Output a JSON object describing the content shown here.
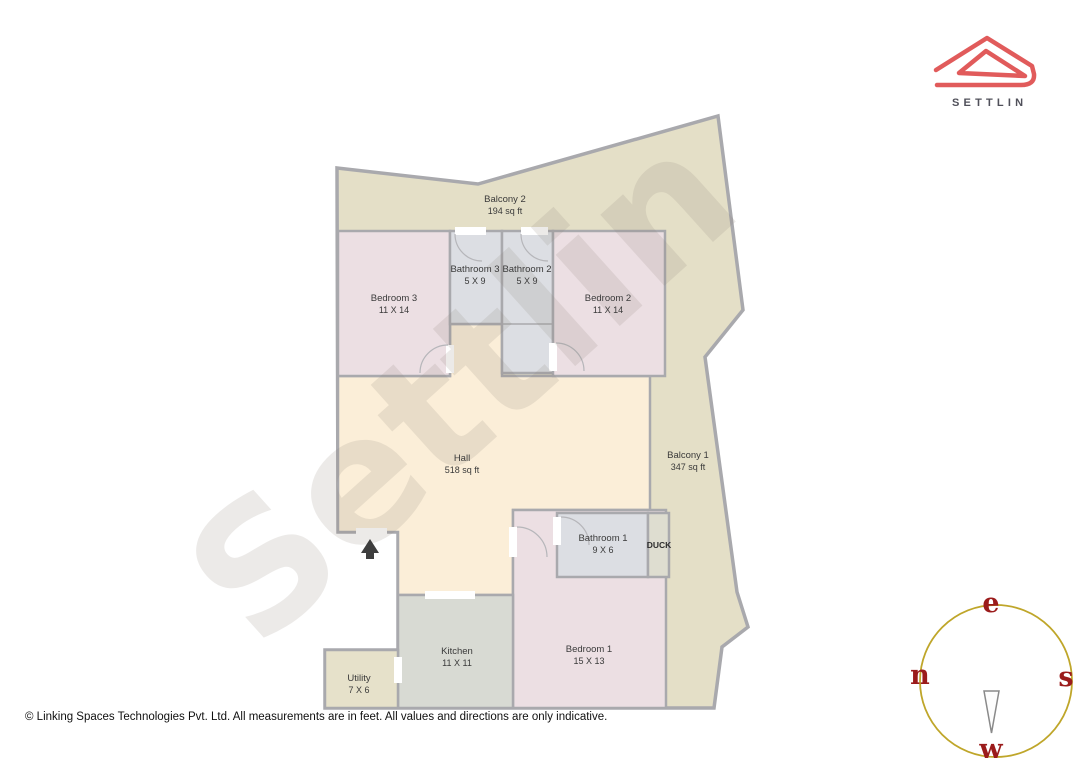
{
  "logo": {
    "brand": "SETTLIN"
  },
  "watermark": {
    "text": "Settlin"
  },
  "rooms": [
    {
      "name": "Balcony 2",
      "dims": "194 sq ft"
    },
    {
      "name": "Bedroom 3",
      "dims": "11 X 14"
    },
    {
      "name": "Bathroom 3",
      "dims": "5 X 9"
    },
    {
      "name": "Bathroom 2",
      "dims": "5 X 9"
    },
    {
      "name": "Bedroom 2",
      "dims": "11 X 14"
    },
    {
      "name": "Hall",
      "dims": "518 sq ft"
    },
    {
      "name": "Balcony 1",
      "dims": "347 sq ft"
    },
    {
      "name": "Bathroom 1",
      "dims": "9 X 6"
    },
    {
      "name": "DUCK",
      "dims": ""
    },
    {
      "name": "Bedroom 1",
      "dims": "15 X 13"
    },
    {
      "name": "Kitchen",
      "dims": "11 X 11"
    },
    {
      "name": "Utility",
      "dims": "7 X 6"
    }
  ],
  "compass": {
    "east": "e",
    "south": "s",
    "west": "w",
    "north": "n"
  },
  "footer": {
    "copyright": "© Linking Spaces Technologies Pvt. Ltd. All measurements are in feet. All values and directions are only indicative."
  },
  "palette": {
    "balcony": "#e4dfc7",
    "bedroom": "#ecdfe3",
    "bathroom": "#dcdee3",
    "hall": "#fbeed8",
    "kitchen": "#d8dad3",
    "utility": "#e6e1ca",
    "duck": "#deddd0",
    "wall": "#a9a9ad",
    "entrance_arrow": "#3e3e3e",
    "logo_red": "#e15b5b",
    "compass_ring": "#bfa62a",
    "compass_letters": "#9b1b1b",
    "watermark_gray": "#8c8378"
  }
}
